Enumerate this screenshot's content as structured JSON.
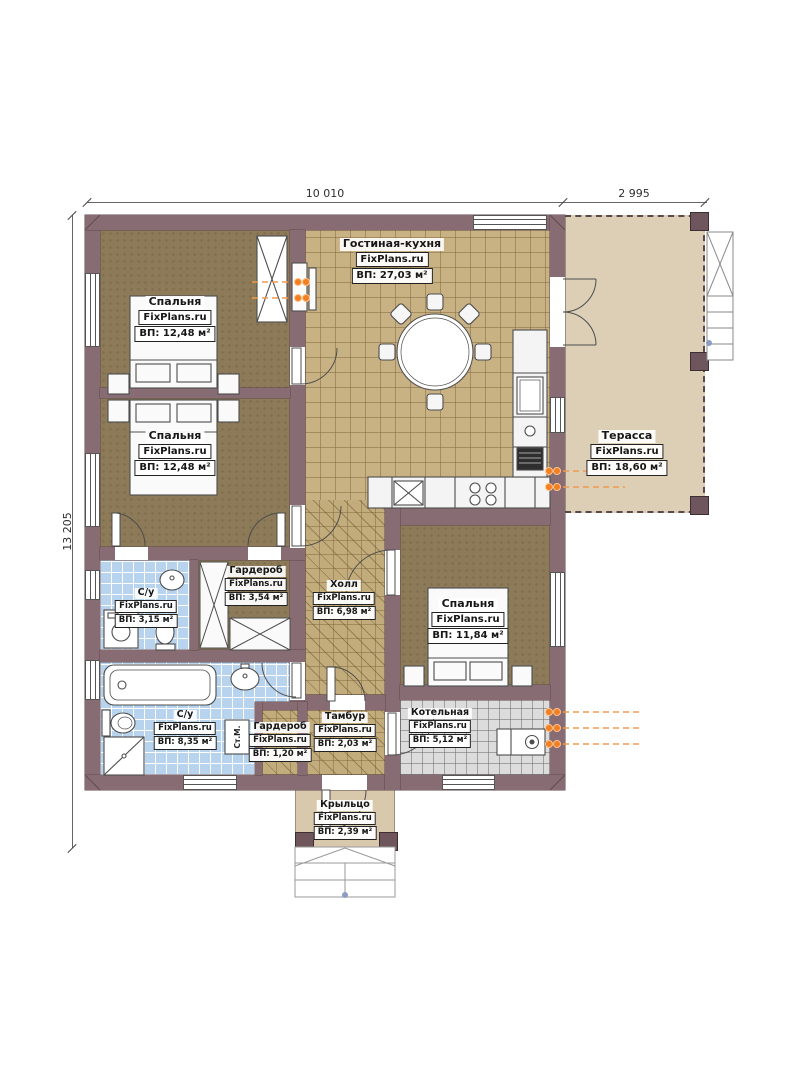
{
  "watermark": "FixPlans.ru",
  "dimensions": {
    "top_main": "10 010",
    "top_terrace": "2 995",
    "side_total": "13 205"
  },
  "rooms": {
    "bedroom1": {
      "name": "Спальня",
      "area": "ВП: 12,48 м²"
    },
    "bedroom2": {
      "name": "Спальня",
      "area": "ВП: 12,48 м²"
    },
    "living_kitchen": {
      "name": "Гостиная-кухня",
      "area": "ВП: 27,03 м²"
    },
    "terrace": {
      "name": "Терасса",
      "area": "ВП: 18,60 м²"
    },
    "bath_small": {
      "name": "С/у",
      "area": "ВП: 3,15 м²"
    },
    "wardrobe_big": {
      "name": "Гардероб",
      "area": "ВП: 3,54 м²"
    },
    "hall": {
      "name": "Холл",
      "area": "ВП: 6,98 м²"
    },
    "bedroom3": {
      "name": "Спальня",
      "area": "ВП: 11,84 м²"
    },
    "bath_big": {
      "name": "С/у",
      "area": "ВП: 8,35 м²"
    },
    "wardrobe_small": {
      "name": "Гардероб",
      "area": "ВП: 1,20 м²"
    },
    "tambour": {
      "name": "Тамбур",
      "area": "ВП: 2,03 м²"
    },
    "boiler": {
      "name": "Котельная",
      "area": "ВП: 5,12 м²"
    },
    "porch": {
      "name": "Крыльцо",
      "area": "ВП: 2,39 м²"
    }
  },
  "labels": {
    "washing_machine": "Ст.М."
  },
  "colors": {
    "wall": "#876d73",
    "bedroom_floor": "#8c7a58",
    "tile_floor": "#c8b183",
    "terrace_floor": "#ddcfb6",
    "bath_floor": "#b7d3ee",
    "boiler_floor": "#dcdcdc",
    "porch_floor": "#d8c8ac",
    "radiator": "#f08022"
  }
}
